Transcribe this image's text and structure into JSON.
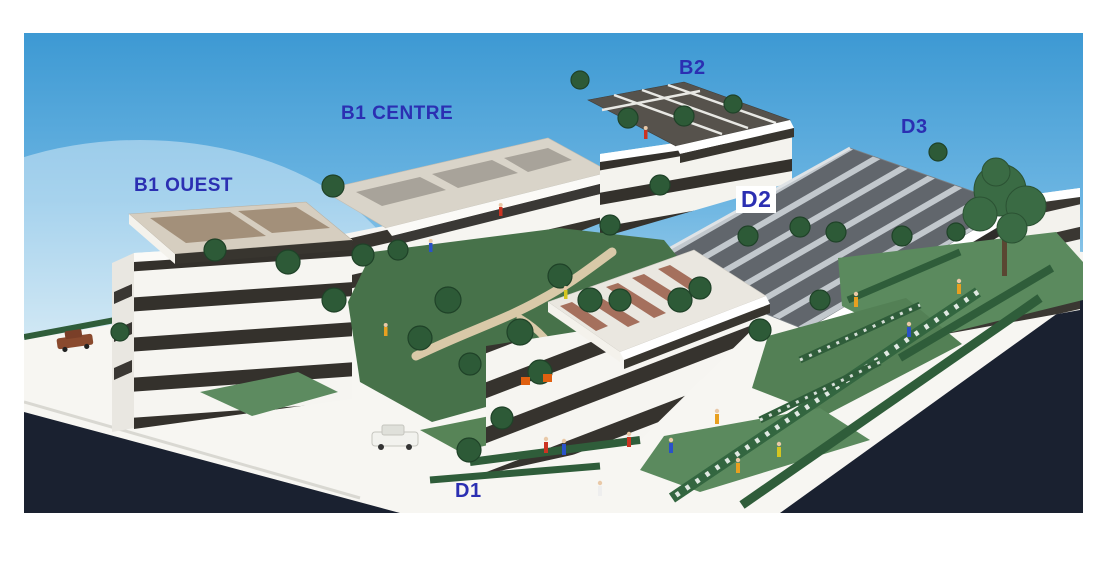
{
  "photo": {
    "kind": "architectural-scale-model-photograph",
    "labels": [
      {
        "id": "b1-ouest",
        "text": "B1 OUEST"
      },
      {
        "id": "b1-centre",
        "text": "B1 CENTRE"
      },
      {
        "id": "b2",
        "text": "B2"
      },
      {
        "id": "d3",
        "text": "D3"
      },
      {
        "id": "d2",
        "text": "D2"
      },
      {
        "id": "d1",
        "text": "D1"
      }
    ],
    "label_color": "#2b2fb2",
    "colors": {
      "sky_top": "#3d99d3",
      "sky_horizon": "#f0f7f5",
      "road_dark": "#1a2130",
      "ground_white": "#f7f6f2",
      "grass": "#5b8a5e",
      "courtyard_grass": "#47724a",
      "hedge": "#2f5d3a",
      "tree": "#2d5a37",
      "building_white": "#f6f5f1",
      "window_band": "#34312c",
      "roof_tan": "#a3907a",
      "roof_gray_panels": "#61666c",
      "roof_brown_panels": "#a5705d",
      "path_tan": "#d9c9a8"
    }
  }
}
